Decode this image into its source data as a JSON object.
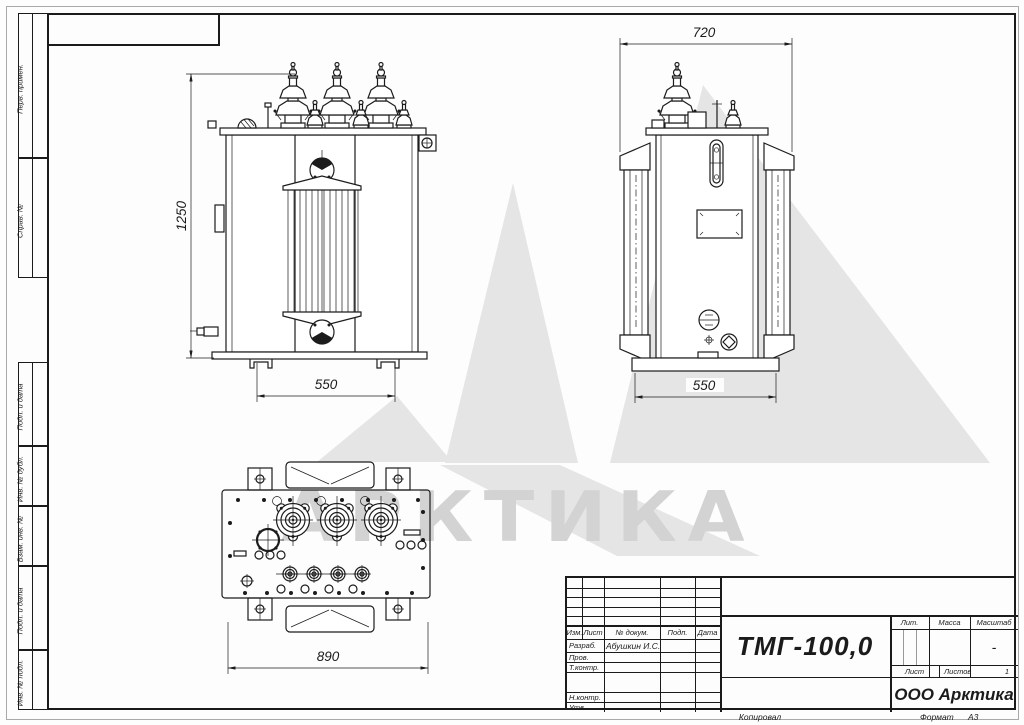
{
  "watermark": {
    "text": "АРКТИКА"
  },
  "dimensions": {
    "front_height": "1250",
    "front_width": "550",
    "side_depth": "720",
    "side_width": "550",
    "top_length": "890"
  },
  "frame": {
    "strip_labels": [
      "Перв. примен.",
      "Справ. №",
      "Подп. и дата",
      "Инв. № дубл.",
      "Взам. инв. №",
      "Подп. и дата",
      "Инв. № подл."
    ],
    "footer": {
      "copied": "Копировал",
      "format_label": "Формат",
      "format_value": "А3"
    }
  },
  "title_block": {
    "designation": "ТМГ-100,0",
    "company": "ООО Арктика",
    "columns": [
      "Изм.",
      "Лист",
      "№ докум.",
      "Подп.",
      "Дата"
    ],
    "rows": [
      {
        "label": "Разраб.",
        "value": "Абушкин И.С."
      },
      {
        "label": "Пров.",
        "value": ""
      },
      {
        "label": "Т.контр.",
        "value": ""
      },
      {
        "label": "",
        "value": ""
      },
      {
        "label": "Н.контр.",
        "value": ""
      },
      {
        "label": "Утв.",
        "value": ""
      }
    ],
    "lit_label": "Лит.",
    "mass_label": "Масса",
    "scale_label": "Масштаб",
    "scale_value": "-",
    "sheet_label": "Лист",
    "sheets_label": "Листов",
    "sheets_value": "1"
  }
}
